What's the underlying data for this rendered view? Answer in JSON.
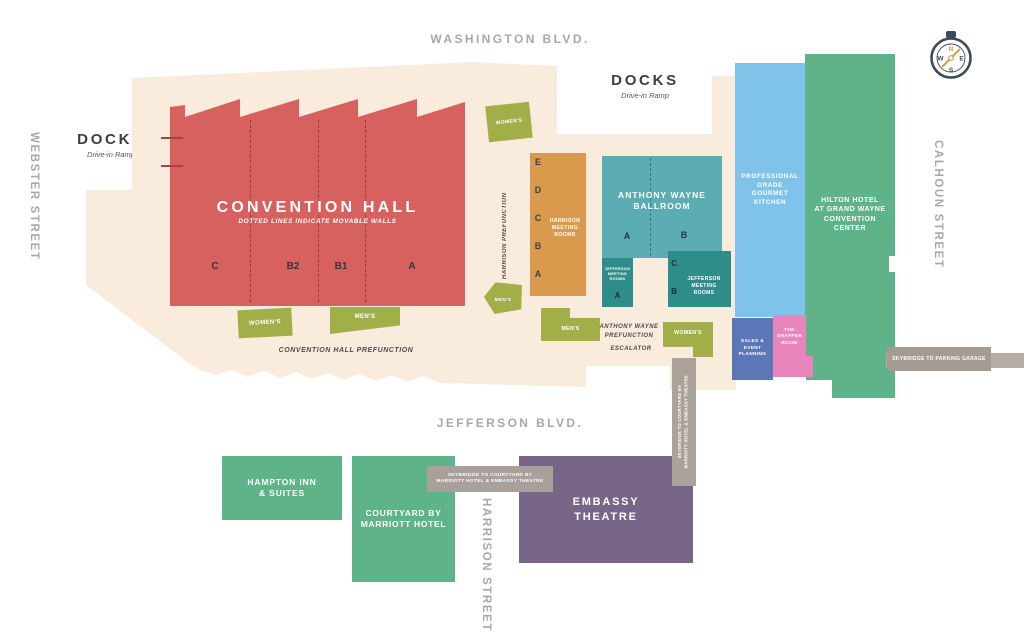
{
  "streets": {
    "washington": "WASHINGTON BLVD.",
    "webster": "WEBSTER STREET",
    "calhoun": "CALHOUN STREET",
    "harrison": "HARRISON STREET",
    "jefferson": "JEFFERSON BLVD."
  },
  "docks": {
    "left_title": "DOCKS",
    "left_subtitle": "Drive-in Ramp",
    "top_title": "DOCKS",
    "top_subtitle": "Drive-in Ramp"
  },
  "convention_hall": {
    "title": "CONVENTION HALL",
    "subtitle": "DOTTED LINES INDICATE MOVABLE WALLS",
    "sections": [
      "C",
      "B2",
      "B1",
      "A"
    ],
    "prefunction": "CONVENTION HALL PREFUNCTION"
  },
  "harrison_rooms": {
    "label": "HARRISON\nMEETING\nROOMS",
    "sections": [
      "E",
      "D",
      "C",
      "B",
      "A"
    ],
    "prefunction": "HARRISON PREFUNCTION"
  },
  "ballroom": {
    "title": "ANTHONY WAYNE\nBALLROOM",
    "section_a": "A",
    "section_b": "B",
    "prefunction": "ANTHONY WAYNE\nPREFUNCTION",
    "escalator": "ESCALATOR"
  },
  "jefferson_rooms": {
    "label": "JEFFERSON\nMEETING\nROOMS",
    "section_a": "A",
    "section_b": "B",
    "section_c": "C"
  },
  "kitchen": {
    "label": "PROFESSIONAL\nGRADE\nGOURMET\nKITCHEN"
  },
  "hilton": {
    "label": "HILTON HOTEL\nAT GRAND WAYNE\nCONVENTION\nCENTER"
  },
  "sales_event": {
    "label": "SALES &\nEVENT\nPLANNING"
  },
  "shaffer": {
    "label": "THE\nSHAFFER\nROOM"
  },
  "restrooms": {
    "womens": "WOMEN'S",
    "mens": "MEN'S"
  },
  "skybridges": {
    "parking": "SKYBRIDGE TO PARKING GARAGE",
    "courtyard_embassy": "SKYBRIDGE TO COURTYARD BY\nMARRIOTT HOTEL & EMBASSY THEATRE",
    "vertical": "SKYBRIDGE TO COURTYARD BY\nMARRIOTT HOTEL & EMBASSY THEATRE"
  },
  "hotels": {
    "hampton": "HAMPTON INN\n& SUITES",
    "courtyard": "COURTYARD BY\nMARRIOTT HOTEL"
  },
  "embassy": {
    "label": "EMBASSY\nTHEATRE"
  },
  "compass": {
    "n": "N",
    "e": "E",
    "s": "S",
    "w": "W"
  },
  "colors": {
    "floor": "#faecdd",
    "hall_red": "#d6615e",
    "restroom_green": "#a2af49",
    "meeting_orange": "#d99a4d",
    "ballroom_teal": "#5cadb3",
    "jefferson_teal": "#2e8d8b",
    "kitchen_blue": "#7fc3ea",
    "hotel_green": "#5fb389",
    "sales_blue": "#5b77b7",
    "shaffer_pink": "#e886bc",
    "embassy_purple": "#786689",
    "skybridge_gray": "#aba39a",
    "street_gray": "#a8a8a8",
    "compass_navy": "#3e4a5e",
    "compass_gold": "#c9a14a"
  }
}
